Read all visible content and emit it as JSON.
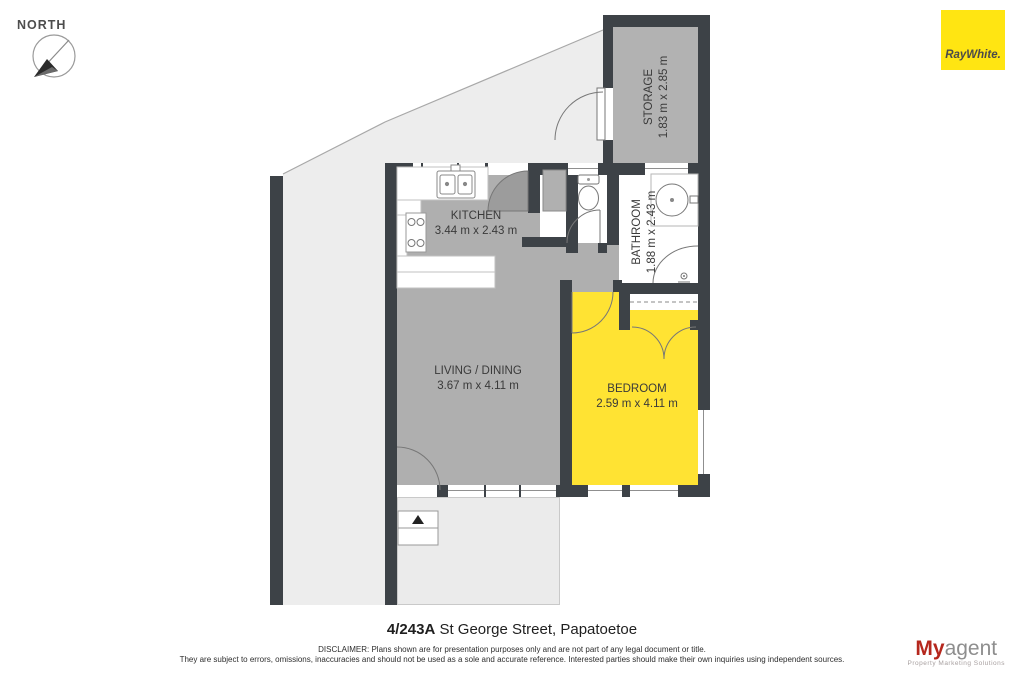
{
  "header": {
    "north_label": "NORTH"
  },
  "brand": {
    "raywhite_text": "RayWhite.",
    "raywhite_yellow": "#ffe512"
  },
  "floorplan": {
    "rooms": [
      {
        "id": "storage",
        "name": "STORAGE",
        "dims": "1.83 m x 2.85 m"
      },
      {
        "id": "kitchen",
        "name": "KITCHEN",
        "dims": "3.44 m x 2.43 m"
      },
      {
        "id": "bathroom",
        "name": "BATHROOM",
        "dims": "1.88 m x 2.43 m"
      },
      {
        "id": "living",
        "name": "LIVING / DINING",
        "dims": "3.67 m x 4.11 m"
      },
      {
        "id": "bedroom",
        "name": "BEDROOM",
        "dims": "2.59 m x 4.11 m"
      }
    ],
    "colors": {
      "wall": "#3d4247",
      "floor_gray": "#afafaf",
      "storage_gray": "#b2b2b2",
      "bedroom_yellow": "#ffe333",
      "yard_gray": "#ededed"
    }
  },
  "footer": {
    "address_number": "4/243A",
    "address_rest": " St George Street, Papatoetoe",
    "disclaimer_line1": "DISCLAIMER: Plans shown are for presentation purposes only and are not part of any legal document or title.",
    "disclaimer_line2": "They are subject to errors, omissions, inaccuracies and should not be used as a sole and accurate reference. Interested parties should make their own inquiries using independent sources.",
    "myagent_my": "My",
    "myagent_agent": "agent",
    "myagent_tagline": "Property Marketing Solutions"
  }
}
